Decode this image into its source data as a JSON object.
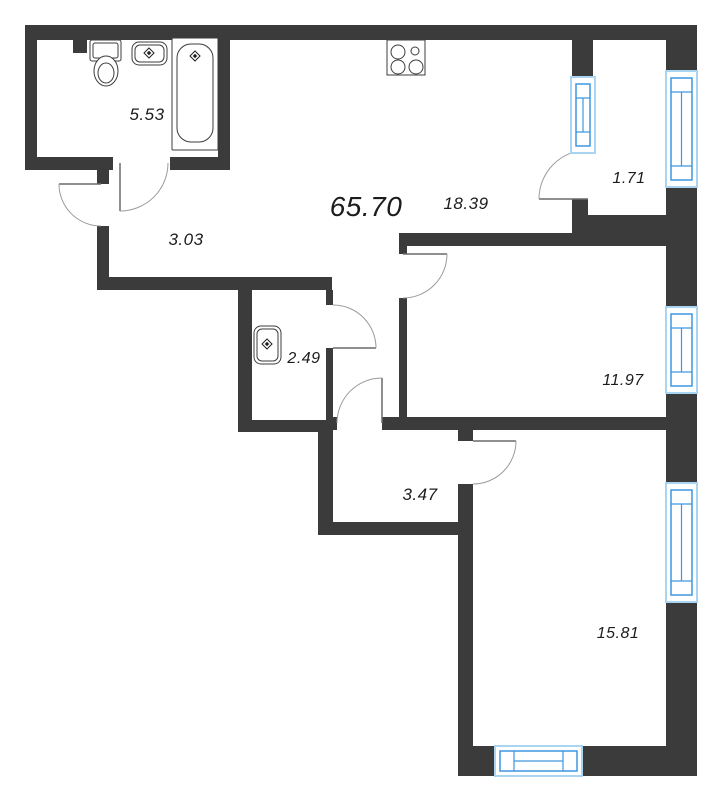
{
  "title": {
    "total_area": "65.70"
  },
  "total_label": {
    "cx": 366,
    "cy": 207,
    "fs": 28
  },
  "rooms": [
    {
      "name": "bathroom",
      "area": "5.53",
      "cx": 147,
      "cy": 115,
      "fs": 17
    },
    {
      "name": "entry-hall",
      "area": "3.03",
      "cx": 186,
      "cy": 240,
      "fs": 17
    },
    {
      "name": "kitchen-living",
      "area": "18.39",
      "cx": 466,
      "cy": 204,
      "fs": 17
    },
    {
      "name": "balcony",
      "area": "1.71",
      "cx": 629,
      "cy": 179,
      "fs": 16
    },
    {
      "name": "wc",
      "area": "2.49",
      "cx": 304,
      "cy": 359,
      "fs": 16
    },
    {
      "name": "bedroom-1",
      "area": "11.97",
      "cx": 623,
      "cy": 381,
      "fs": 16
    },
    {
      "name": "inner-hall",
      "area": "3.47",
      "cx": 420,
      "cy": 495,
      "fs": 17
    },
    {
      "name": "bedroom-2",
      "area": "15.81",
      "cx": 618,
      "cy": 634,
      "fs": 16
    }
  ],
  "colors": {
    "wall": "#3b3b3b",
    "window_frame_light": "#a9d5f2",
    "window_frame_blue": "#3e97e1",
    "door_arc": "#9b9b9b",
    "door_leaf": "#6a6a6a",
    "fixture_line": "#3c3c3c",
    "text": "#1c1c1c",
    "background": "#ffffff"
  },
  "plan": {
    "width": 726,
    "height": 800,
    "walls": [
      [
        25,
        25,
        672,
        15
      ],
      [
        25,
        25,
        12,
        145
      ],
      [
        73,
        37,
        14,
        16
      ],
      [
        218,
        40,
        12,
        130
      ],
      [
        25,
        157,
        88,
        13
      ],
      [
        170,
        157,
        60,
        13
      ],
      [
        97,
        170,
        12,
        14
      ],
      [
        97,
        226,
        12,
        64
      ],
      [
        97,
        277,
        235,
        13
      ],
      [
        238,
        277,
        14,
        155
      ],
      [
        326,
        290,
        7,
        15
      ],
      [
        326,
        348,
        7,
        72
      ],
      [
        238,
        420,
        95,
        12
      ],
      [
        318,
        432,
        15,
        103
      ],
      [
        318,
        522,
        152,
        13
      ],
      [
        326,
        417,
        11,
        13
      ],
      [
        382,
        417,
        285,
        13
      ],
      [
        458,
        430,
        15,
        11
      ],
      [
        458,
        484,
        15,
        262
      ],
      [
        458,
        746,
        239,
        30
      ],
      [
        666,
        25,
        31,
        47
      ],
      [
        666,
        187,
        31,
        120
      ],
      [
        666,
        393,
        31,
        90
      ],
      [
        666,
        602,
        31,
        144
      ],
      [
        572,
        40,
        21,
        37
      ],
      [
        572,
        199,
        16,
        47
      ],
      [
        588,
        215,
        79,
        31
      ],
      [
        399,
        233,
        189,
        13
      ],
      [
        399,
        246,
        8,
        8
      ],
      [
        399,
        298,
        8,
        119
      ]
    ],
    "windows": [
      {
        "name": "window-balcony-divider",
        "x": 571,
        "y": 77,
        "w": 24,
        "h": 76,
        "dir": "v"
      },
      {
        "name": "window-balcony-east",
        "x": 666,
        "y": 71,
        "w": 31,
        "h": 116,
        "dir": "v"
      },
      {
        "name": "window-bedroom-1",
        "x": 666,
        "y": 307,
        "w": 31,
        "h": 86,
        "dir": "v"
      },
      {
        "name": "window-bedroom-2-east",
        "x": 666,
        "y": 483,
        "w": 31,
        "h": 119,
        "dir": "v"
      },
      {
        "name": "window-bedroom-2-south",
        "x": 495,
        "y": 746,
        "w": 87,
        "h": 30,
        "dir": "h"
      }
    ],
    "doors": [
      {
        "name": "door-bathroom",
        "hx": 120,
        "hy": 163,
        "lx": 120,
        "ly": 211,
        "ax": 168,
        "ay": 163,
        "sweep": 0
      },
      {
        "name": "door-entrance",
        "hx": 101,
        "hy": 184,
        "lx": 59,
        "ly": 184,
        "ax": 101,
        "ay": 226,
        "sweep": 0
      },
      {
        "name": "door-wc",
        "hx": 333,
        "hy": 348,
        "lx": 376,
        "ly": 348,
        "ax": 333,
        "ay": 305,
        "sweep": 0
      },
      {
        "name": "door-bedroom-1",
        "hx": 403,
        "hy": 254,
        "lx": 447,
        "ly": 254,
        "ax": 403,
        "ay": 298,
        "sweep": 1
      },
      {
        "name": "door-inner-hall",
        "hx": 382,
        "hy": 423,
        "lx": 382,
        "ly": 378,
        "ax": 337,
        "ay": 423,
        "sweep": 0
      },
      {
        "name": "door-bedroom-2",
        "hx": 473,
        "hy": 441,
        "lx": 516,
        "ly": 441,
        "ax": 473,
        "ay": 484,
        "sweep": 1
      },
      {
        "name": "door-balcony",
        "hx": 588,
        "hy": 199,
        "lx": 539,
        "ly": 199,
        "ax": 588,
        "ay": 150,
        "sweep": 1
      }
    ],
    "fixtures": [
      {
        "kind": "rect",
        "name": "toilet-tank",
        "x": 90,
        "y": 40,
        "w": 31,
        "h": 21,
        "rx": 2
      },
      {
        "kind": "rect",
        "name": "toilet-tank-inner",
        "x": 93,
        "y": 43,
        "w": 25,
        "h": 15,
        "rx": 2
      },
      {
        "kind": "ellipse",
        "name": "toilet-bowl",
        "cx": 106,
        "cy": 71,
        "rx": 12,
        "ry": 15
      },
      {
        "kind": "ellipse",
        "name": "toilet-bowl-inner",
        "cx": 106,
        "cy": 73,
        "rx": 8,
        "ry": 10
      },
      {
        "kind": "rect",
        "name": "sink-bathroom",
        "x": 132,
        "y": 42,
        "w": 35,
        "h": 23,
        "rx": 7
      },
      {
        "kind": "rect",
        "name": "sink-bathroom-inner",
        "x": 135,
        "y": 45,
        "w": 29,
        "h": 17,
        "rx": 5
      },
      {
        "kind": "diamond",
        "name": "faucet-icon",
        "cx": 149,
        "cy": 53,
        "r": 5
      },
      {
        "kind": "rect",
        "name": "bathtub",
        "x": 172,
        "y": 38,
        "w": 46,
        "h": 112,
        "rx": 1
      },
      {
        "kind": "rect",
        "name": "bathtub-basin",
        "x": 177,
        "y": 44,
        "w": 36,
        "h": 98,
        "rx": 14
      },
      {
        "kind": "diamond",
        "name": "faucet-icon",
        "cx": 195,
        "cy": 56,
        "r": 5
      },
      {
        "kind": "rect",
        "name": "stove",
        "x": 387,
        "y": 40,
        "w": 38,
        "h": 35,
        "rx": 0
      },
      {
        "kind": "circle",
        "name": "burner-icon",
        "cx": 398,
        "cy": 52,
        "r": 7
      },
      {
        "kind": "circle",
        "name": "burner-icon",
        "cx": 415,
        "cy": 51,
        "r": 4
      },
      {
        "kind": "circle",
        "name": "burner-icon",
        "cx": 398,
        "cy": 67,
        "r": 7
      },
      {
        "kind": "circle",
        "name": "burner-icon",
        "cx": 416,
        "cy": 67,
        "r": 7
      },
      {
        "kind": "rect",
        "name": "sink-wc",
        "x": 254,
        "y": 326,
        "w": 27,
        "h": 38,
        "rx": 7
      },
      {
        "kind": "rect",
        "name": "sink-wc-inner",
        "x": 257,
        "y": 329,
        "w": 21,
        "h": 32,
        "rx": 5
      },
      {
        "kind": "diamond",
        "name": "faucet-icon",
        "cx": 267,
        "cy": 344,
        "r": 5
      }
    ]
  }
}
